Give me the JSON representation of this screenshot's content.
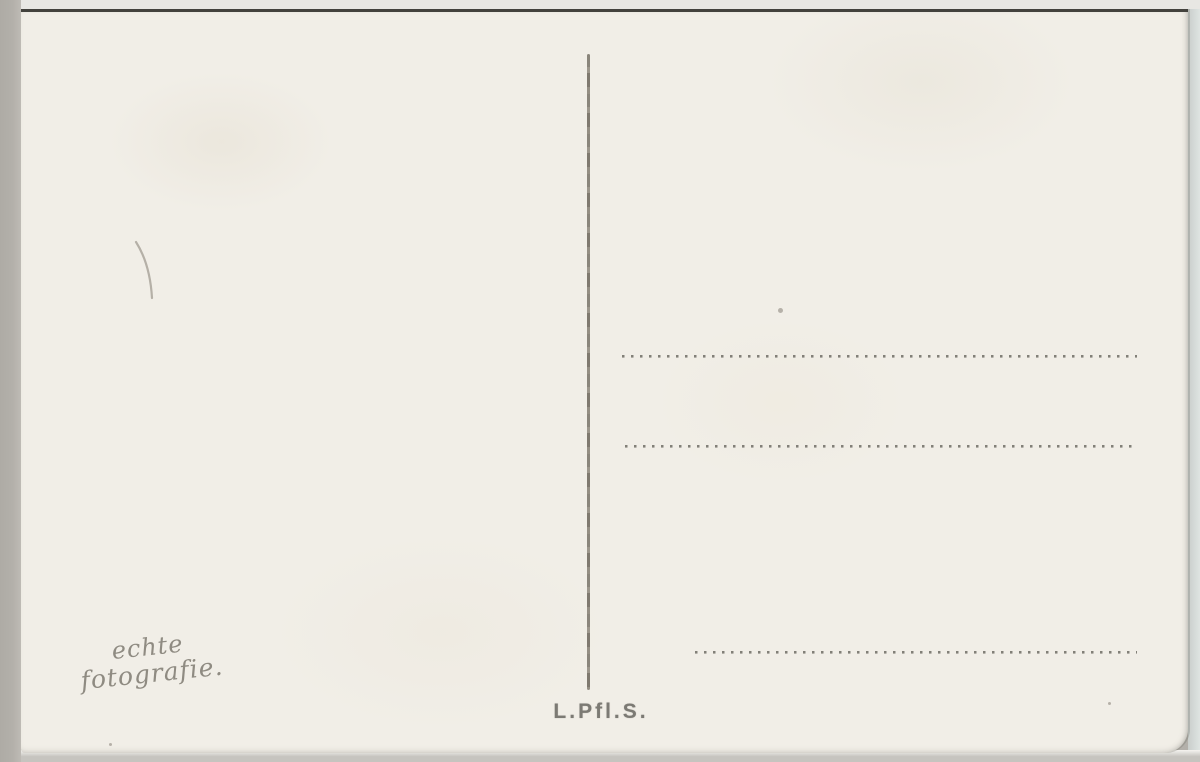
{
  "postcard": {
    "publisher_mark": "L.Pfl.S.",
    "handwriting_line1": "echte",
    "handwriting_line2": "fotografie.",
    "address_field_lines": [
      {
        "style": "dotted",
        "x": 601,
        "y": 343,
        "width": 515
      },
      {
        "style": "dotted",
        "x": 604,
        "y": 433,
        "width": 510
      },
      {
        "style": "solid",
        "x": 674,
        "y": 554,
        "width": 445
      },
      {
        "style": "dotted",
        "x": 674,
        "y": 639,
        "width": 442
      }
    ]
  },
  "colors": {
    "card": "#f1eee7",
    "ink": "#6e6c65",
    "rule_solid": "#504e48",
    "divider": "#8a857b",
    "handwriting": "#8f8b82",
    "publisher_text": "#7c7a74",
    "scan_edge_left": "#b3b0aa",
    "scan_edge_right": "#dfe4e2",
    "scan_edge_bottom": "#c6c4bf",
    "scan_edge_top_line": "#43423d",
    "scan_top_strip": "#e8e7e3"
  }
}
